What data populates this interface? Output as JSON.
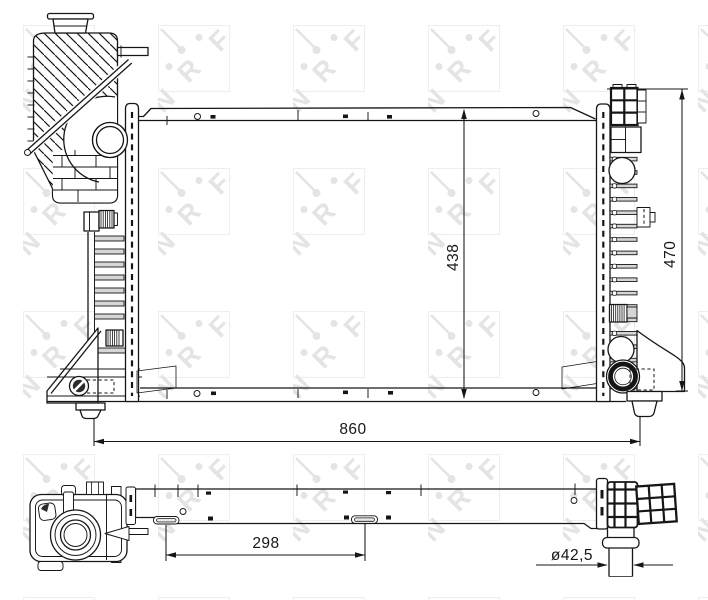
{
  "page": {
    "background": "#ffffff",
    "line_color": "#161616",
    "watermark_color": "#e4e4e4",
    "drawing_type": "radiator technical drawing"
  },
  "watermark": {
    "brand": "NRF",
    "letters": [
      "N",
      "R",
      "F"
    ]
  },
  "views": {
    "front_view": "radiator front elevation with expansion tank, side plates and hose ports",
    "bottom_view": "radiator bottom projection with expansion tank cap and outlet pipe"
  },
  "dimensions": {
    "core_height": "438",
    "overall_height": "470",
    "overall_width": "860",
    "bracket_spacing": "298",
    "hose_diameter": "ø42,5"
  }
}
